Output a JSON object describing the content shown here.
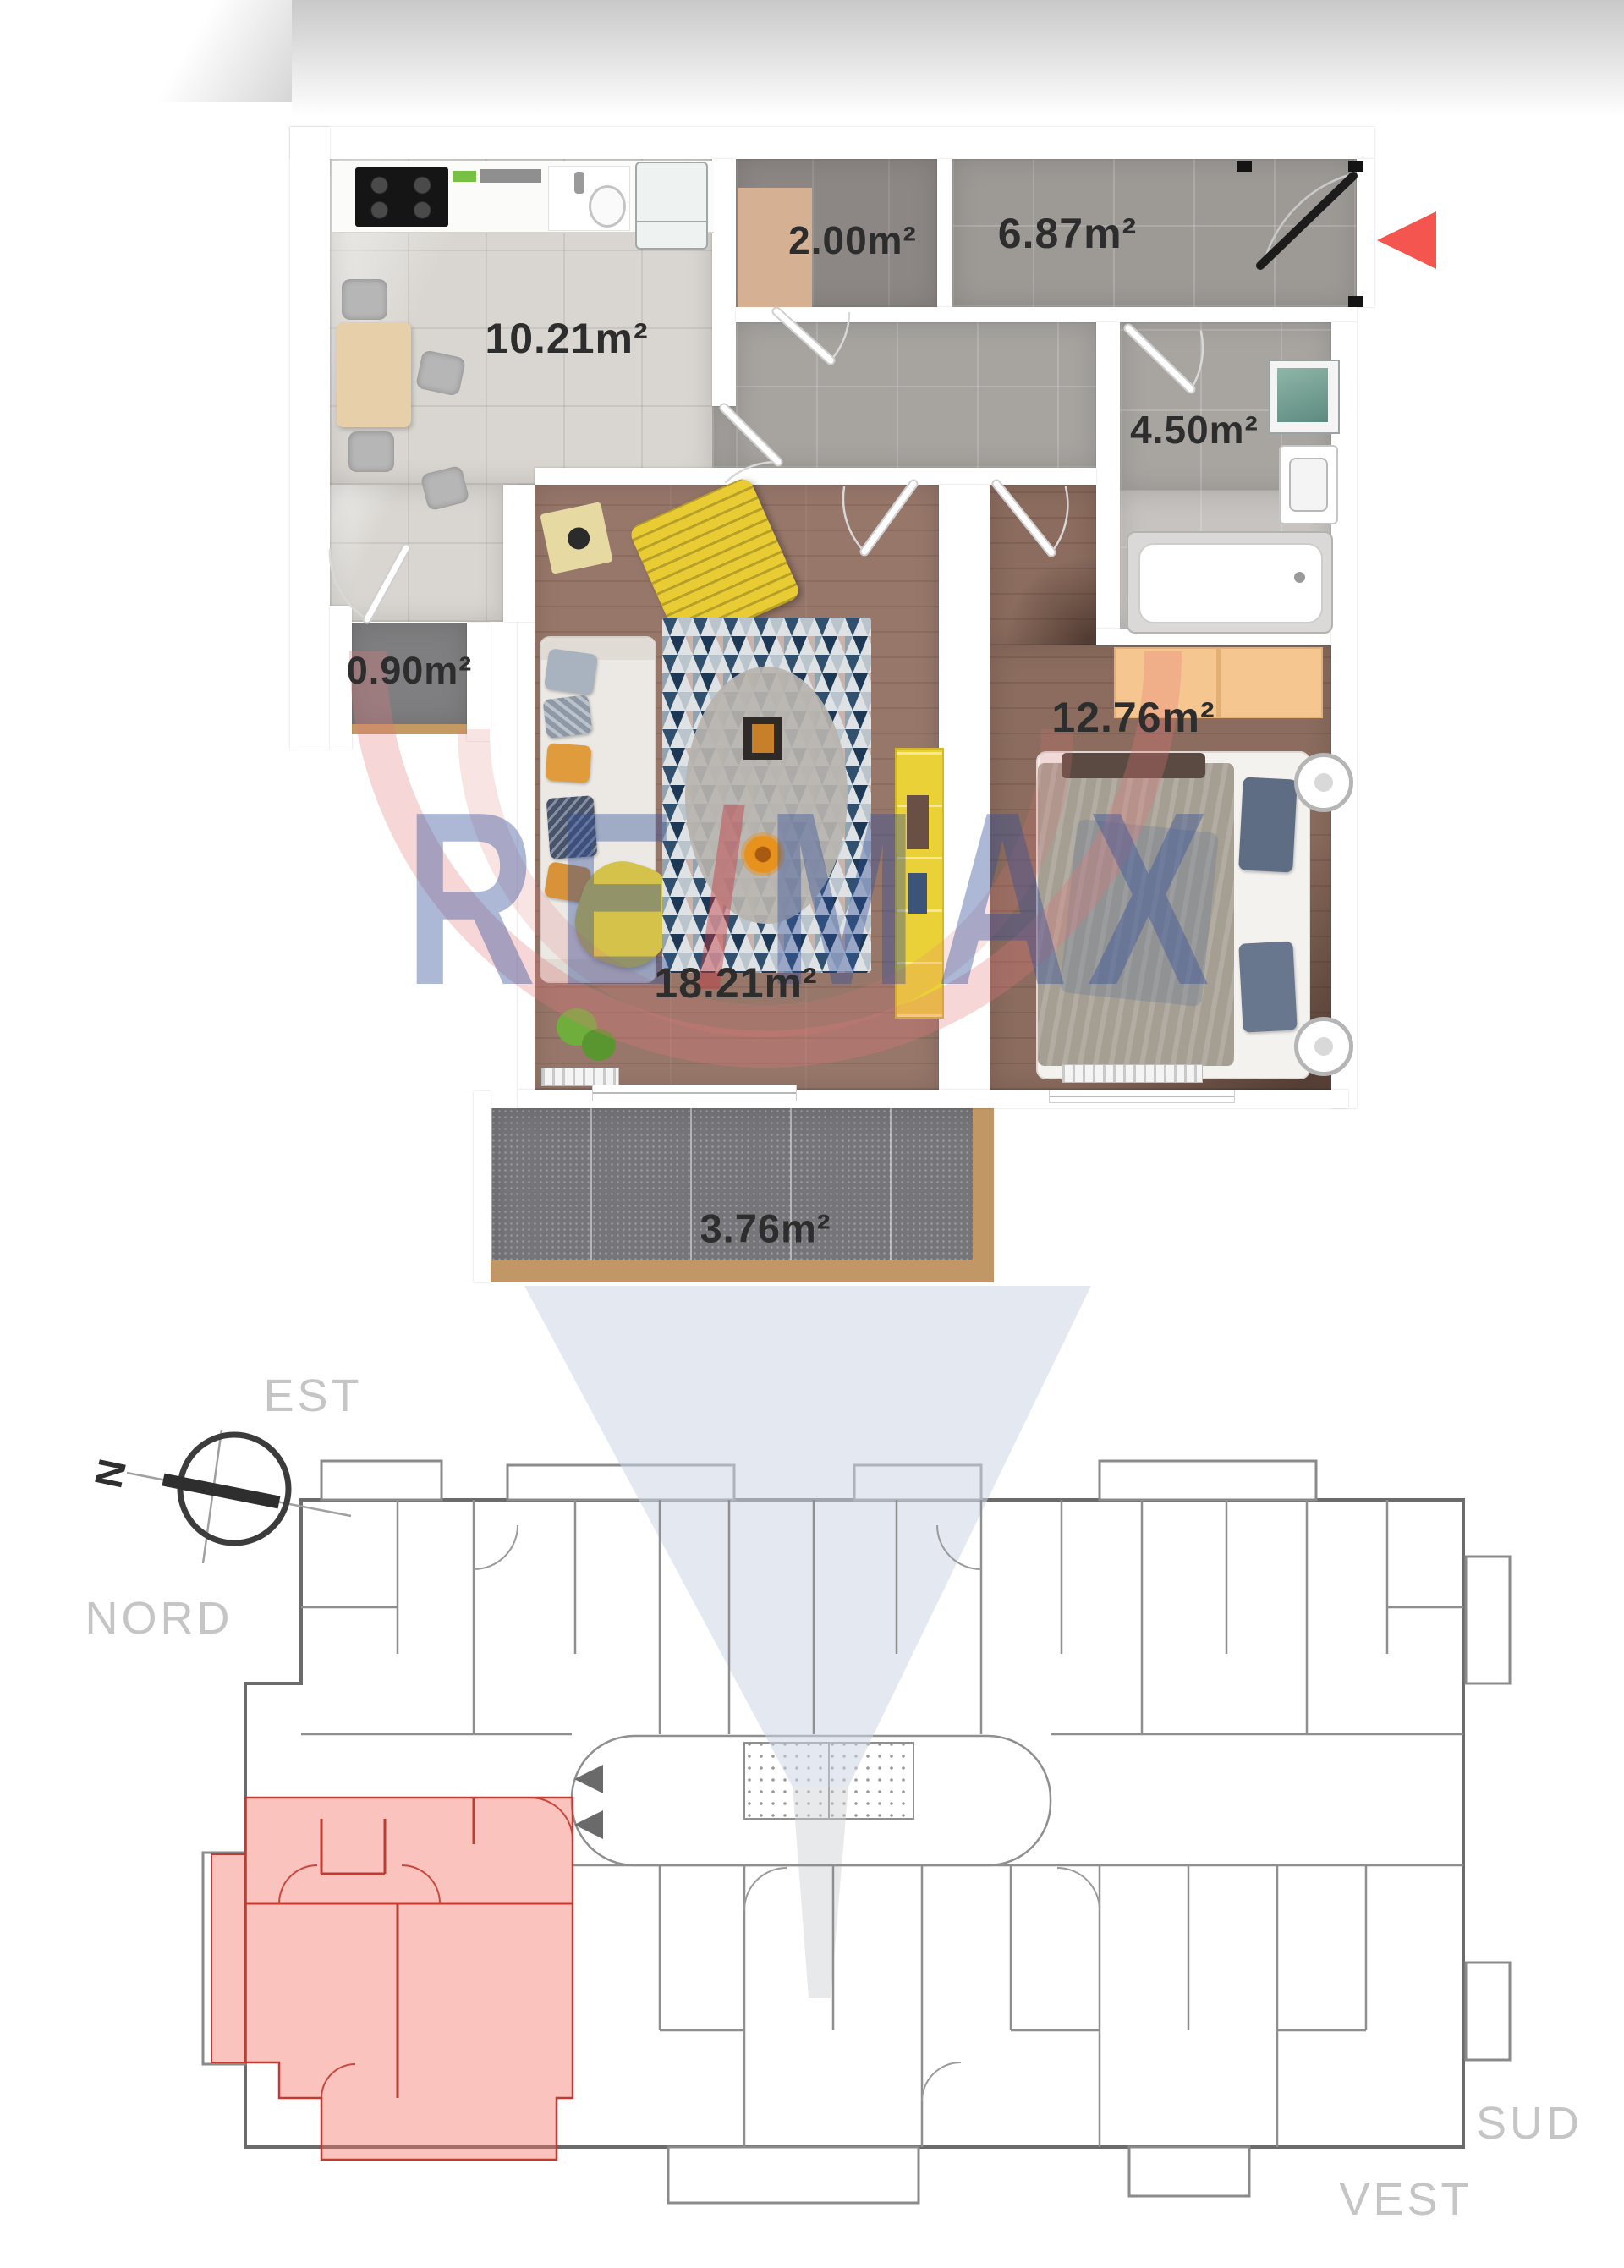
{
  "floorplan": {
    "rooms": {
      "kitchen": "10.21m²",
      "wardrobe": "2.00m²",
      "hallway": "6.87m²",
      "bathroom": "4.50m²",
      "storage": "0.90m²",
      "living_room": "18.21m²",
      "bedroom": "12.76m²",
      "balcony": "3.76m²"
    }
  },
  "watermark": {
    "left": "RE",
    "slash": "/",
    "right": "MAX"
  },
  "site_plan": {
    "compass_north": "N",
    "direction_est": "EST",
    "direction_nord": "NORD",
    "direction_sud": "SUD",
    "direction_vest": "VEST"
  },
  "colors": {
    "entrance_marker": "#f4564f",
    "unit_highlight": "#f3705f",
    "unit_outline": "#c23b31",
    "watermark_blue": "#2f4d99",
    "watermark_red": "#c43c42"
  }
}
